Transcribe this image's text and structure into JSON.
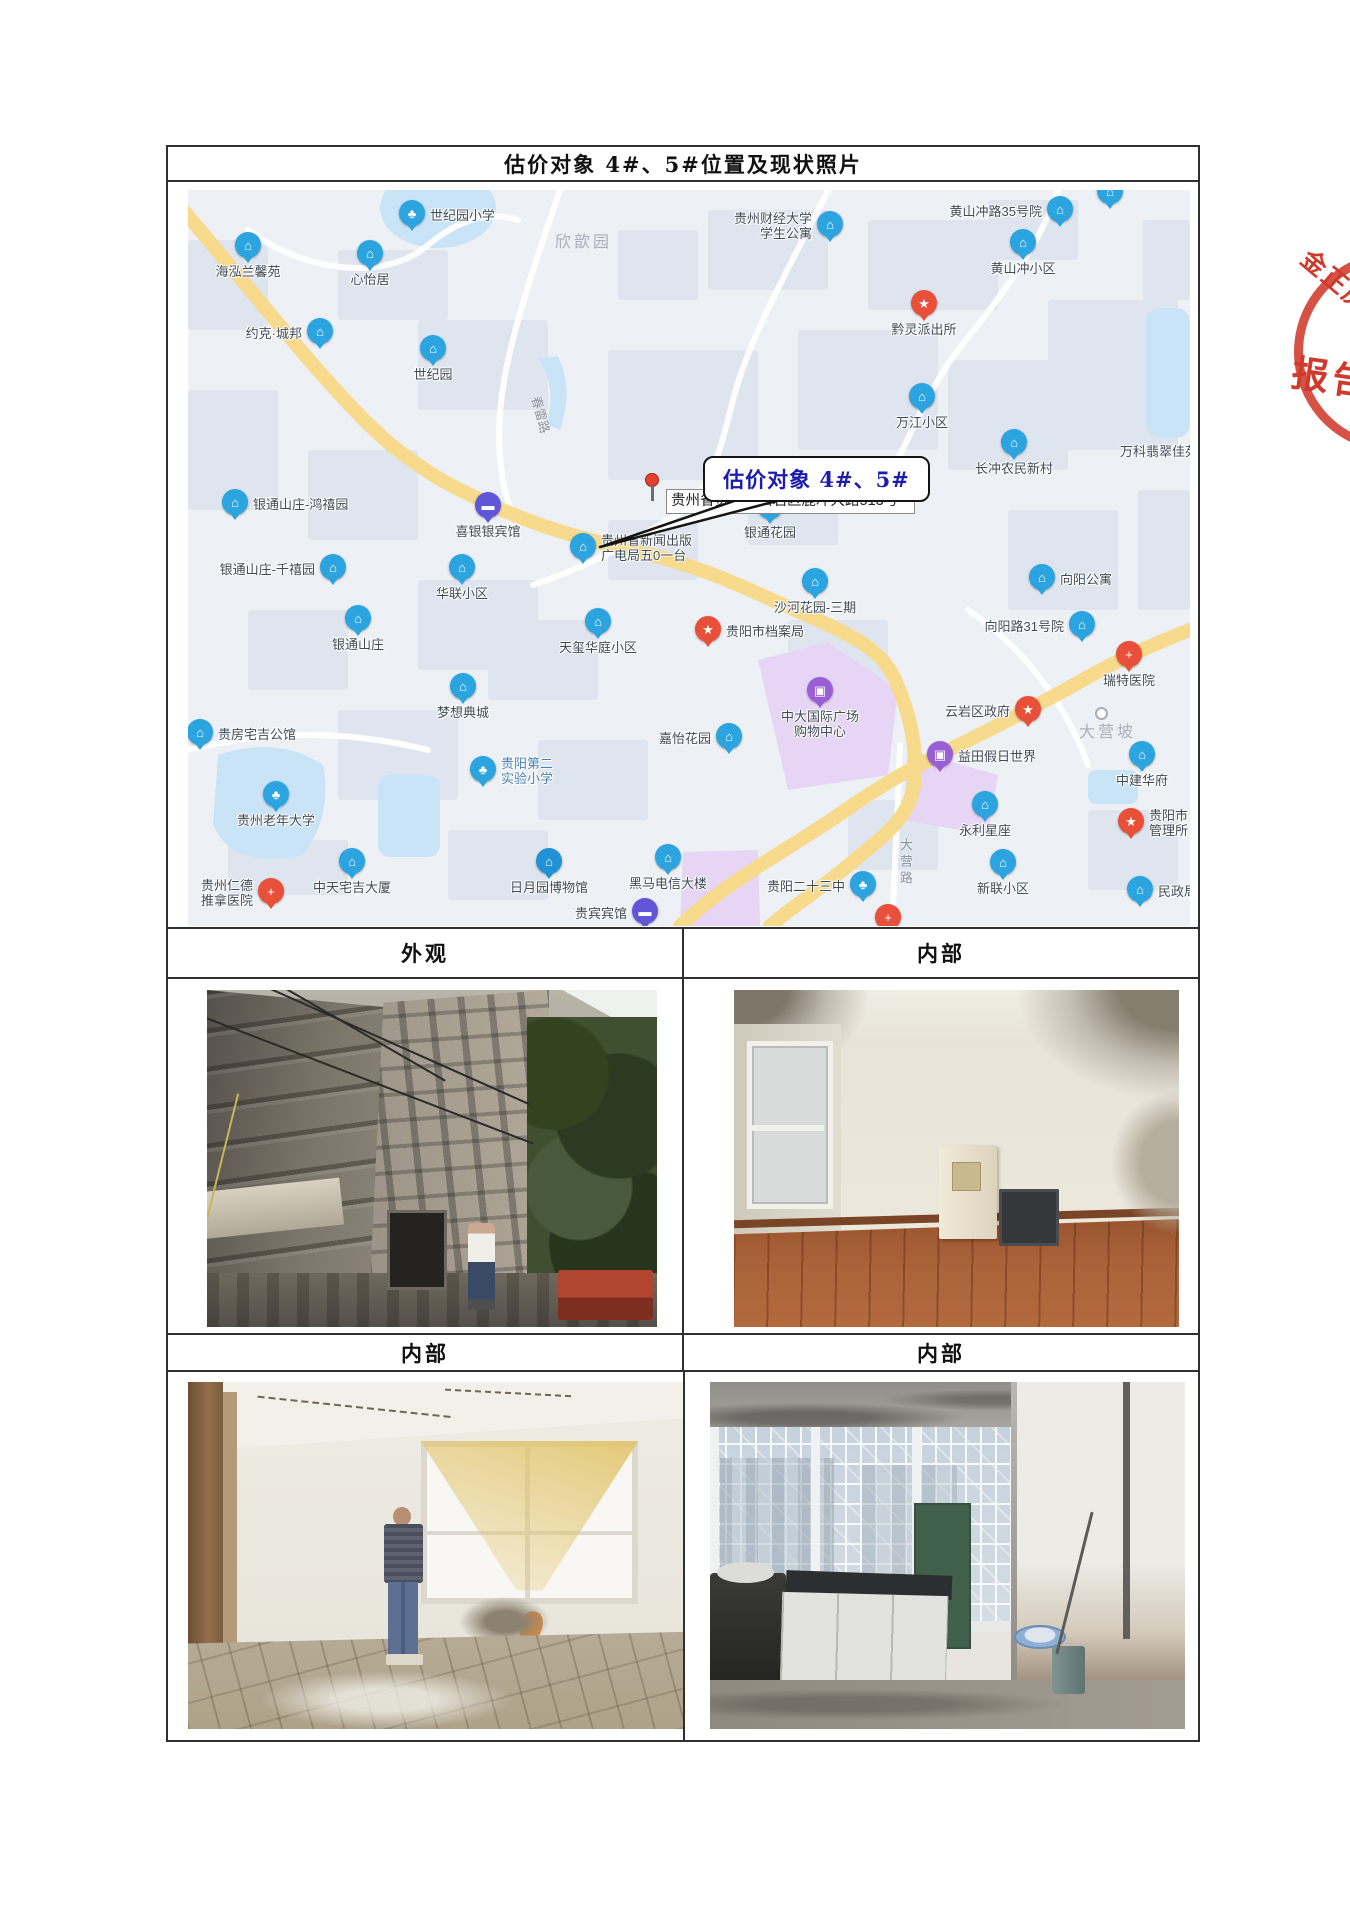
{
  "table": {
    "title": "估价对象 4#、5#位置及现状照片"
  },
  "stamp": {
    "line1": "金正房",
    "line2": "报告",
    "color": "#d03a2c"
  },
  "sections": [
    {
      "label": "外观"
    },
    {
      "label": "内部"
    },
    {
      "label": "内部"
    },
    {
      "label": "内部"
    }
  ],
  "photos": {
    "subjects": [
      "building-exterior",
      "interior-room",
      "interior-room-with-person",
      "interior-kitchen"
    ]
  },
  "map": {
    "target": {
      "callout": "估价对象 4#、5#",
      "address": "贵州省贵阳市云岩区鹿冲大路513号"
    },
    "colors": {
      "pin_blue": "#2ba4e0",
      "pin_red": "#e8503a",
      "pin_purple": "#9a5fd6",
      "pin_indigo": "#6156d8",
      "road_yellow": "#f7da8c",
      "water": "#c9e3f7",
      "zone_purple": "#e6d5f4",
      "label_text": "#3f4a55",
      "callout_text": "#1c1cae"
    },
    "glyphs": {
      "house": "⌂",
      "school": "♣",
      "hotel": "▬",
      "shop": "▣",
      "star": "★",
      "cross": "+",
      "badge": "★",
      "tower": "⌂",
      "museum": "⌂",
      "none": ""
    },
    "pins": [
      {
        "id": "shijiyuan-primary",
        "label": "世纪园小学",
        "type": "school",
        "x": 224,
        "y": 26,
        "side": "right"
      },
      {
        "id": "haihong-lanxinyuan",
        "label": "海泓兰馨苑",
        "type": "house",
        "x": 60,
        "y": 58,
        "side": "below"
      },
      {
        "id": "xinyiju",
        "label": "心怡居",
        "type": "house",
        "x": 182,
        "y": 66,
        "side": "below"
      },
      {
        "id": "yueke-chengbang",
        "label": "约克·城邦",
        "type": "house",
        "x": 132,
        "y": 144,
        "side": "left"
      },
      {
        "id": "shijiyuan",
        "label": "世纪园",
        "type": "house",
        "x": 245,
        "y": 161,
        "side": "below"
      },
      {
        "id": "caida-xuesheng-gongyu",
        "label": "贵州财经大学\n学生公寓",
        "type": "house",
        "x": 642,
        "y": 37,
        "side": "left"
      },
      {
        "id": "huangshanchonglu-35",
        "label": "黄山冲路35号院",
        "type": "house",
        "x": 872,
        "y": 22,
        "side": "left"
      },
      {
        "id": "huangshanchong-xiaoqu",
        "label": "黄山冲小区",
        "type": "house",
        "x": 835,
        "y": 55,
        "side": "below"
      },
      {
        "id": "qianling-paichusuo",
        "label": "黔灵派出所",
        "type": "badge",
        "x": 736,
        "y": 116,
        "side": "below"
      },
      {
        "id": "wanjiang-xiaoqu",
        "label": "万江小区",
        "type": "house",
        "x": 734,
        "y": 209,
        "side": "below"
      },
      {
        "id": "changchong-nongmin-xincun",
        "label": "长冲农民新村",
        "type": "house",
        "x": 826,
        "y": 255,
        "side": "below"
      },
      {
        "id": "wanke-feicui",
        "label": "万科翡翠佳苑",
        "type": "none",
        "x": 932,
        "y": 254,
        "side": "plain"
      },
      {
        "id": "xiangyang-gongyu",
        "label": "向阳公寓",
        "type": "house",
        "x": 854,
        "y": 390,
        "side": "right"
      },
      {
        "id": "yintong-hongxiyuan",
        "label": "银通山庄-鸿禧园",
        "type": "house",
        "x": 47,
        "y": 315,
        "side": "right"
      },
      {
        "id": "xiyinyin-binguan",
        "label": "喜银银宾馆",
        "type": "hotel",
        "x": 300,
        "y": 318,
        "side": "below"
      },
      {
        "id": "yintong-qianxiyuan",
        "label": "银通山庄-千禧园",
        "type": "house",
        "x": 145,
        "y": 380,
        "side": "left"
      },
      {
        "id": "hualian-xiaoqu",
        "label": "华联小区",
        "type": "house",
        "x": 274,
        "y": 380,
        "side": "below"
      },
      {
        "id": "yintong-shanzhuang",
        "label": "银通山庄",
        "type": "house",
        "x": 170,
        "y": 431,
        "side": "below"
      },
      {
        "id": "guangdian-501",
        "label": "贵州省新闻出版\n广电局五0一台",
        "type": "tower",
        "x": 395,
        "y": 359,
        "side": "right"
      },
      {
        "id": "yintong-huayuan",
        "label": "银通花园",
        "type": "house",
        "x": 582,
        "y": 319,
        "side": "below"
      },
      {
        "id": "shahe-huayuan-sanqi",
        "label": "沙河花园-三期",
        "type": "house",
        "x": 627,
        "y": 394,
        "side": "below"
      },
      {
        "id": "guiyang-danganju",
        "label": "贵阳市档案局",
        "type": "star",
        "x": 520,
        "y": 442,
        "side": "right"
      },
      {
        "id": "tianxi-huating",
        "label": "天玺华庭小区",
        "type": "house",
        "x": 410,
        "y": 434,
        "side": "below"
      },
      {
        "id": "zhongda-guoji-guangchang",
        "label": "中大国际广场\n购物中心",
        "type": "shop",
        "x": 632,
        "y": 503,
        "side": "below"
      },
      {
        "id": "jiayi-huayuan",
        "label": "嘉怡花园",
        "type": "house",
        "x": 541,
        "y": 549,
        "side": "left"
      },
      {
        "id": "yunyan-qu-zhengfu",
        "label": "云岩区政府",
        "type": "star",
        "x": 840,
        "y": 522,
        "side": "left"
      },
      {
        "id": "ruite-yiyuan",
        "label": "瑞特医院",
        "type": "cross",
        "x": 941,
        "y": 467,
        "side": "below"
      },
      {
        "id": "xiangyanglu-31",
        "label": "向阳路31号院",
        "type": "house",
        "x": 894,
        "y": 437,
        "side": "left"
      },
      {
        "id": "yitian-jiari-shijie",
        "label": "益田假日世界",
        "type": "shop",
        "x": 752,
        "y": 567,
        "side": "right"
      },
      {
        "id": "zhongjian-huafu",
        "label": "中建华府",
        "type": "house",
        "x": 954,
        "y": 567,
        "side": "below"
      },
      {
        "id": "yongli-xingzuo",
        "label": "永利星座",
        "type": "house",
        "x": 797,
        "y": 617,
        "side": "below"
      },
      {
        "id": "guiyangshi-guanlisuo",
        "label": "贵阳市\n管理所",
        "type": "star",
        "x": 943,
        "y": 634,
        "side": "right"
      },
      {
        "id": "mengxiang-diancheng",
        "label": "梦想典城",
        "type": "house",
        "x": 275,
        "y": 499,
        "side": "below"
      },
      {
        "id": "guifang-zhaiji-gongguan",
        "label": "贵房宅吉公馆",
        "type": "house",
        "x": 12,
        "y": 545,
        "side": "right"
      },
      {
        "id": "guizhou-laonian-daxue",
        "label": "贵州老年大学",
        "type": "school",
        "x": 88,
        "y": 607,
        "side": "below"
      },
      {
        "id": "guiyang-dier-shiyan-xiaoxue",
        "label": "贵阳第二\n实验小学",
        "type": "school",
        "x": 295,
        "y": 582,
        "side": "right",
        "label_color": "#4a7fb5"
      },
      {
        "id": "rende-tuina-yiyuan",
        "label": "贵州仁德\n推拿医院",
        "type": "cross",
        "x": 83,
        "y": 704,
        "side": "left"
      },
      {
        "id": "zhongtian-zhaiji-dasha",
        "label": "中天宅吉大厦",
        "type": "house",
        "x": 164,
        "y": 674,
        "side": "below"
      },
      {
        "id": "riyueyuan-bowuguan",
        "label": "日月园博物馆",
        "type": "museum",
        "x": 361,
        "y": 674,
        "side": "below"
      },
      {
        "id": "heima-dianxin-dalou",
        "label": "黑马电信大楼",
        "type": "house",
        "x": 480,
        "y": 670,
        "side": "below"
      },
      {
        "id": "guibin-binguan",
        "label": "贵宾宾馆",
        "type": "hotel",
        "x": 457,
        "y": 724,
        "side": "left"
      },
      {
        "id": "guiyang-ershisan-zhong",
        "label": "贵阳二十三中",
        "type": "school",
        "x": 675,
        "y": 697,
        "side": "left"
      },
      {
        "id": "xinlian-xiaoqu",
        "label": "新联小区",
        "type": "house",
        "x": 815,
        "y": 675,
        "side": "below"
      },
      {
        "id": "minzheng",
        "label": "民政局",
        "type": "house",
        "x": 952,
        "y": 702,
        "side": "right"
      },
      {
        "id": "edge-pin-bottom",
        "label": "",
        "type": "cross",
        "x": 700,
        "y": 730,
        "side": "below"
      },
      {
        "id": "edge-pin-top",
        "label": "",
        "type": "house",
        "x": 922,
        "y": 4,
        "side": "below"
      }
    ],
    "area_labels": [
      {
        "text": "欣歆园",
        "x": 367,
        "y": 38
      },
      {
        "text": "大营坡",
        "x": 891,
        "y": 528,
        "dot": true,
        "dotx": 907,
        "doty": 517
      }
    ],
    "road_labels": [
      {
        "text": "春雷路",
        "x": 335,
        "y": 215,
        "rotate": 75
      },
      {
        "text": "大营路",
        "x": 708,
        "y": 648,
        "vertical": true
      }
    ]
  }
}
